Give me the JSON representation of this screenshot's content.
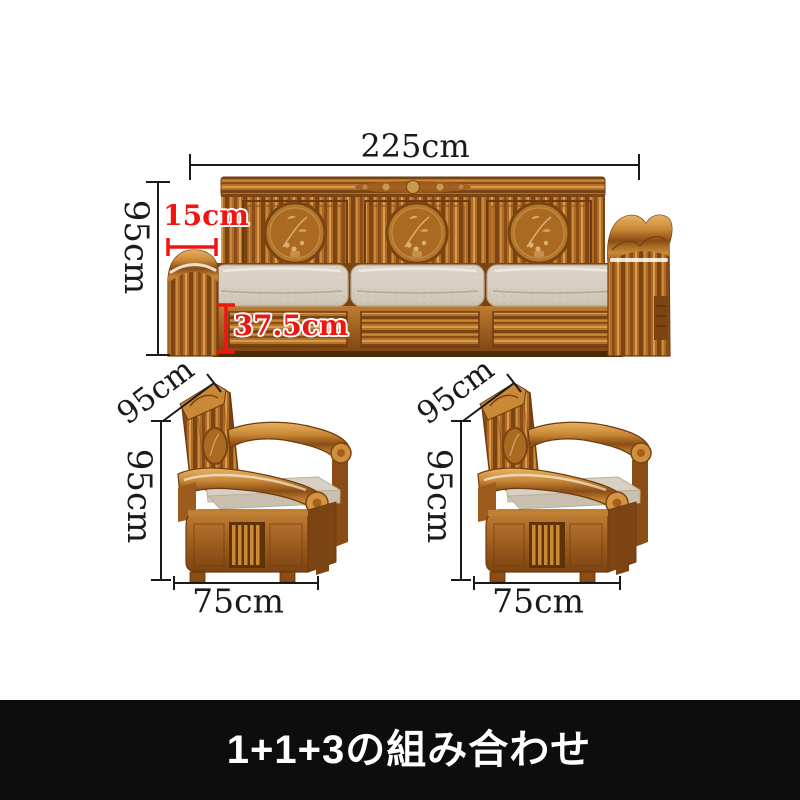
{
  "page": {
    "background": "#ffffff"
  },
  "sofa_section": {
    "width_label": "225cm",
    "height_label": "95cm",
    "armrest_width_label": "15cm",
    "seat_height_label": "37.5cm"
  },
  "left_armchair_section": {
    "depth_label": "95cm",
    "height_label": "95cm",
    "width_label": "75cm"
  },
  "right_armchair_section": {
    "depth_label": "95cm",
    "height_label": "95cm",
    "width_label": "75cm"
  },
  "footer": {
    "caption": "1+1+3の組み合わせ",
    "background_color": "#0d0d0d",
    "text_color": "#ffffff"
  },
  "colors": {
    "dimension_line": "#1a1a1a",
    "highlight_red": "#f01511",
    "wood_light": "#d99c4e",
    "wood_mid": "#b06a24",
    "wood_dark": "#6e3b10",
    "cushion": "#d8d0c2"
  }
}
